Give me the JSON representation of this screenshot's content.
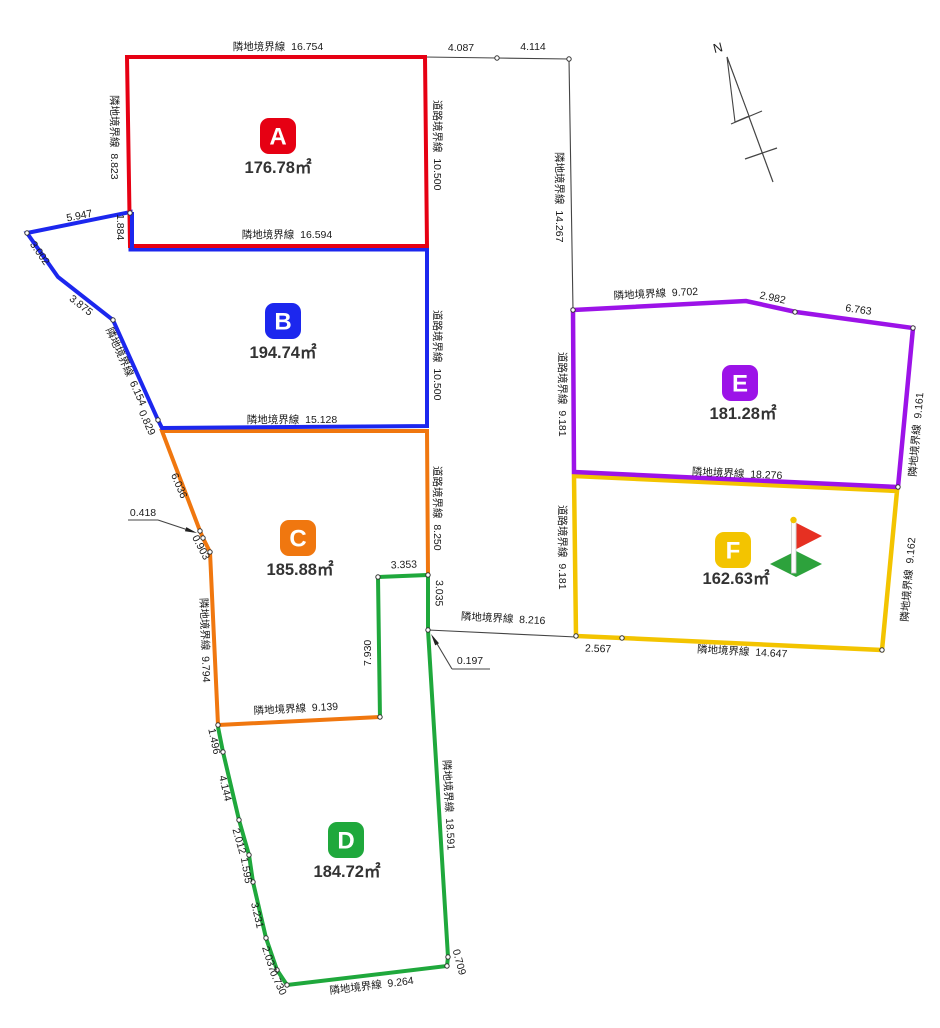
{
  "plots": {
    "a": {
      "letter": "A",
      "area": "176.78㎡",
      "color": "#e60013",
      "top": "隣地境界線  16.754",
      "left": "隣地境界線  8.823",
      "right": "道路境界線  10.500",
      "bottom": "隣地境界線  16.594"
    },
    "b": {
      "letter": "B",
      "area": "194.74㎡",
      "color": "#1c27ee",
      "upper": "1.884",
      "d1": "5.947",
      "d2": "3.002",
      "d3": "3.875",
      "left": "隣地境界線  6.154",
      "d4": "0.829",
      "right": "道路境界線  10.500",
      "bottom": "隣地境界線  15.128"
    },
    "c": {
      "letter": "C",
      "area": "185.88㎡",
      "color": "#f0770f",
      "d1": "6.036",
      "tiny": "0.418",
      "d2": "0.903",
      "left": "隣地境界線  9.794",
      "right": "道路境界線  8.250",
      "notch_top": "3.353",
      "notch_right": "3.035",
      "notch_left": "7.930",
      "bottom": "隣地境界線  9.139"
    },
    "d": {
      "letter": "D",
      "area": "184.72㎡",
      "color": "#1fa83c",
      "l1": "1.496",
      "l2": "4.144",
      "l3": "2.012",
      "l4": "1.595",
      "l5": "3.231",
      "l6": "2.037",
      "l7": "0.730",
      "right": "隣地境界線  18.591",
      "r2": "0.709",
      "bottom": "隣地境界線  9.264",
      "tiny": "0.197"
    },
    "e": {
      "letter": "E",
      "area": "181.28㎡",
      "color": "#9c13e8",
      "top1": "隣地境界線  9.702",
      "top2": "2.982",
      "top3": "6.763",
      "left": "道路境界線  9.181",
      "right": "隣地境界線  9.161",
      "bottom": "隣地境界線  18.276"
    },
    "f": {
      "letter": "F",
      "area": "162.63㎡",
      "color": "#f3c400",
      "left": "道路境界線  9.181",
      "right": "隣地境界線  9.162",
      "b1": "2.567",
      "b2": "隣地境界線  14.647"
    }
  },
  "road": {
    "t1": "4.087",
    "t2": "4.114",
    "mid": "隣地境界線  14.267",
    "lower": "隣地境界線  8.216"
  },
  "compass": {
    "label": "N"
  }
}
